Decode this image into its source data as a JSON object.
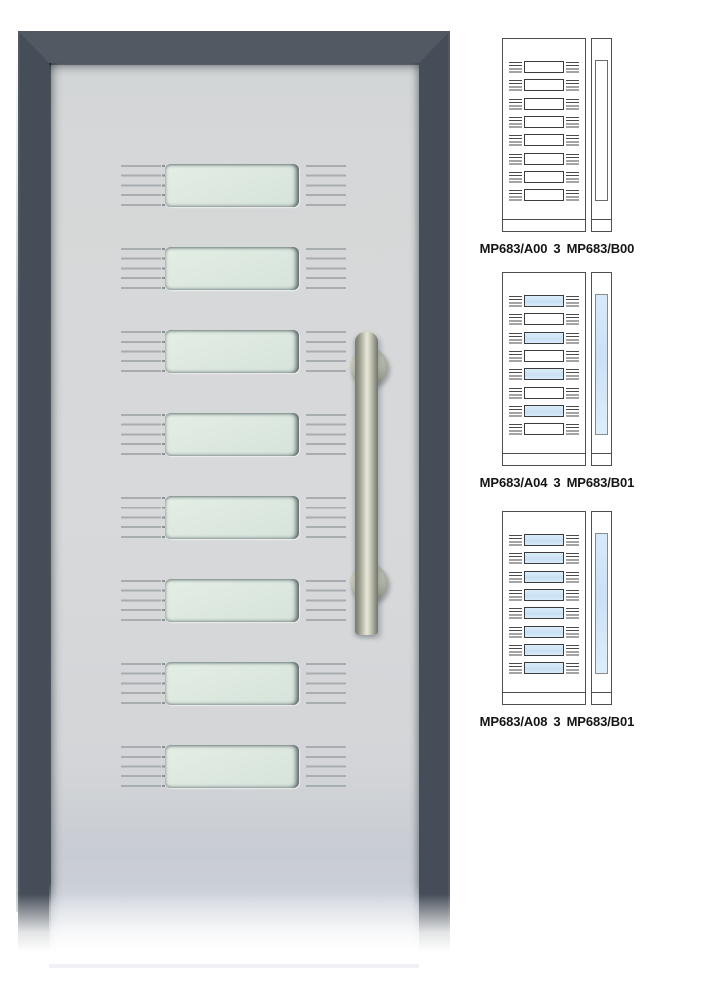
{
  "main_door": {
    "description": "entrance door with 8 horizontal glass slots, grille lines and vertical pull handle",
    "glass_slot_count": 8,
    "colors": {
      "frame_side": "#454e58",
      "frame_top": "#515a63",
      "frame_outer_edge": "#323b44",
      "leaf_panel": "#d5d7d8",
      "glass_mint": "#dce8df",
      "grille_line": "#a8adb0",
      "handle_metal_highlight": "#e9e7d8",
      "handle_metal_shadow": "#70746a"
    }
  },
  "variants": [
    {
      "code_a": "MP683/A00",
      "separator": "3",
      "code_b": "MP683/B00",
      "label": "MP683/A00 3 MP683/B00",
      "door_slots": [
        "clear",
        "clear",
        "clear",
        "clear",
        "clear",
        "clear",
        "clear",
        "clear"
      ],
      "sidelight": "clear"
    },
    {
      "code_a": "MP683/A04",
      "separator": "3",
      "code_b": "MP683/B01",
      "label": "MP683/A04 3 MP683/B01",
      "door_slots": [
        "glazed",
        "clear",
        "glazed",
        "clear",
        "glazed",
        "clear",
        "glazed",
        "clear"
      ],
      "sidelight": "glazed"
    },
    {
      "code_a": "MP683/A08",
      "separator": "3",
      "code_b": "MP683/B01",
      "label": "MP683/A08 3 MP683/B01",
      "door_slots": [
        "glazed",
        "glazed",
        "glazed",
        "glazed",
        "glazed",
        "glazed",
        "glazed",
        "glazed"
      ],
      "sidelight": "glazed"
    }
  ],
  "diagram_colors": {
    "outline": "#4e4e4e",
    "glazed_fill": "#cde2f2",
    "clear_fill": "#ffffff"
  }
}
